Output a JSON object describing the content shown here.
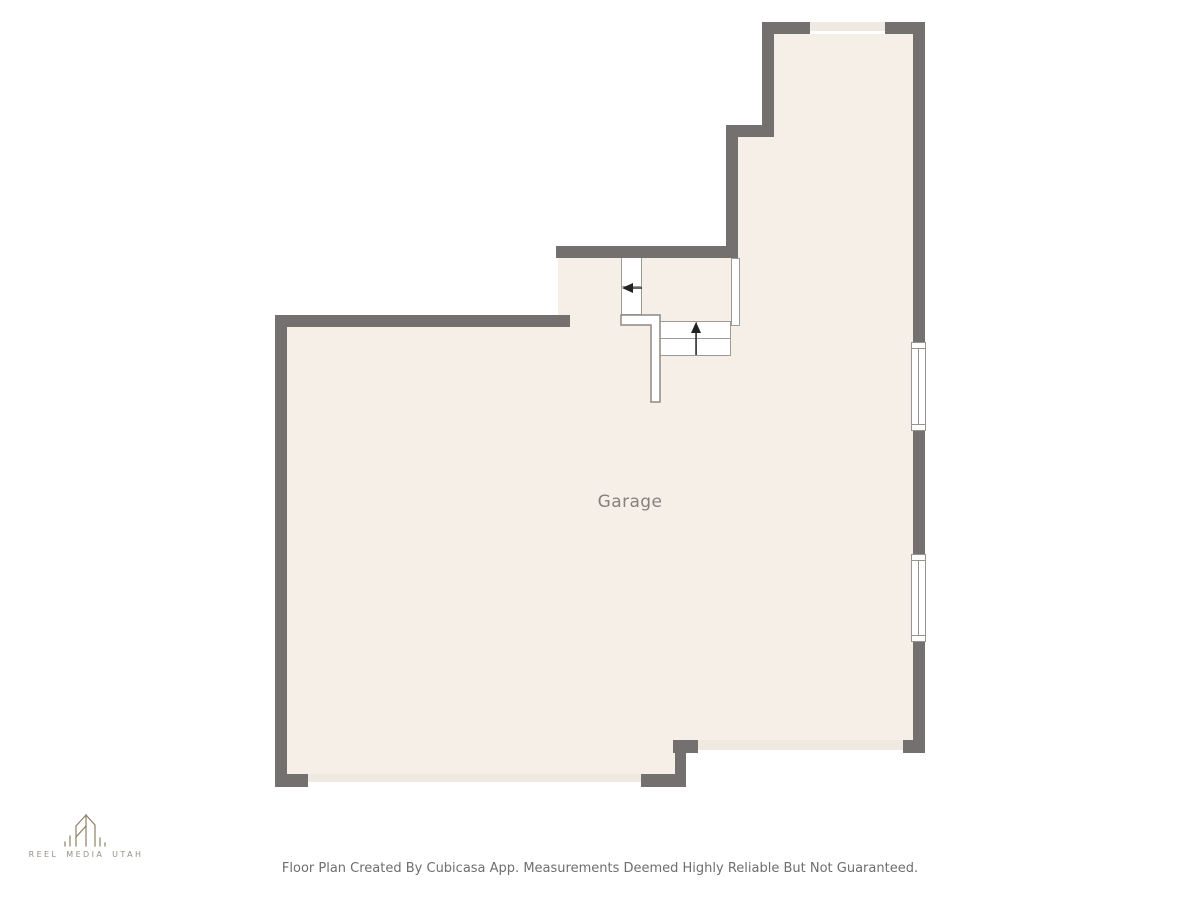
{
  "plan": {
    "room_label": "Garage"
  },
  "footer": {
    "disclaimer": "Floor Plan Created By Cubicasa App. Measurements Deemed Highly Reliable But Not Guaranteed."
  },
  "logo": {
    "name": "REEL MEDIA UTAH"
  },
  "colors": {
    "wall": "#747070",
    "floor": "#f6efe8",
    "opening": "#f0e9e2",
    "outline": "#98938f",
    "stair_outline": "#9e9a96",
    "railing": "#8d8984",
    "arrow": "#222222",
    "room_label": "#85807d",
    "disclaimer_text": "#6e6e6e",
    "logo_text": "#998f84",
    "logo_icon": "#8e8164"
  }
}
